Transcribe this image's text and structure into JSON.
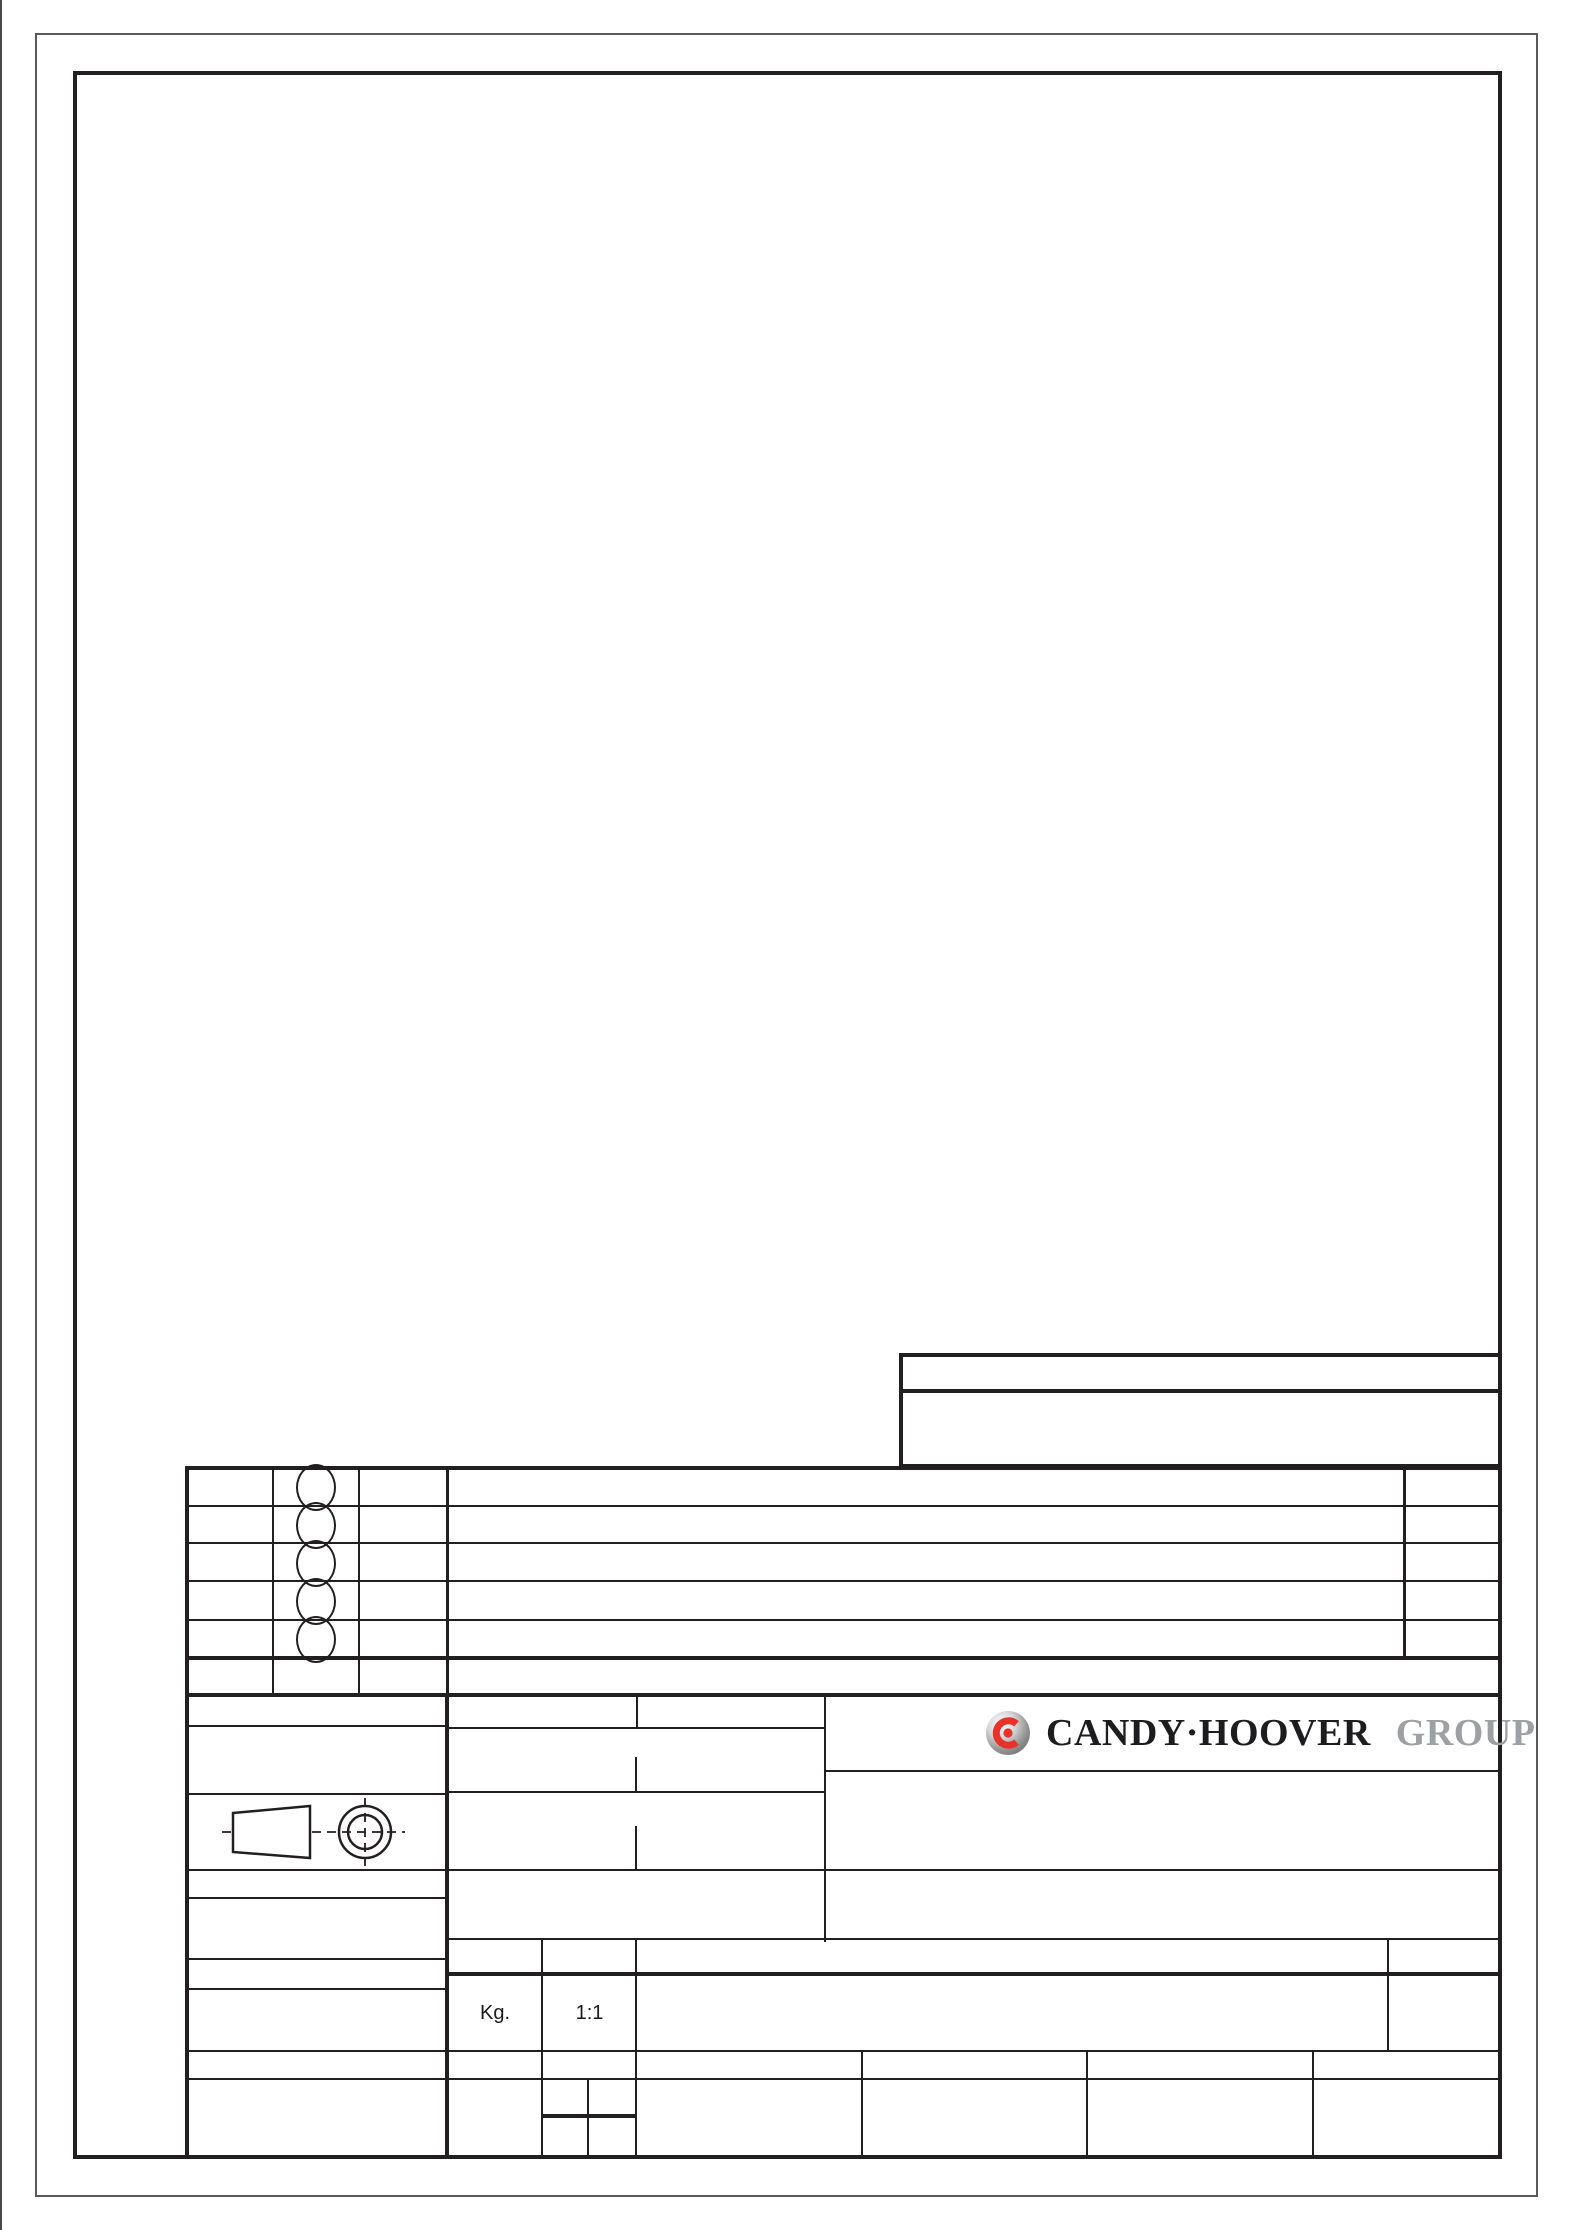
{
  "sheet": {
    "type_label": "engineering-drawing-template",
    "weight_unit_label": "Kg.",
    "scale_label": "1:1",
    "logo": {
      "brand": "CANDY·HOOVER",
      "suffix": "GROUP"
    },
    "colors": {
      "line": "#231f20",
      "outer_border": "#58595b",
      "logo_red": "#e8332a",
      "logo_dark": "#1d1d1f",
      "logo_gray": "#9ba1a4",
      "paper": "#ffffff"
    },
    "revision_balloon_count": 5
  }
}
